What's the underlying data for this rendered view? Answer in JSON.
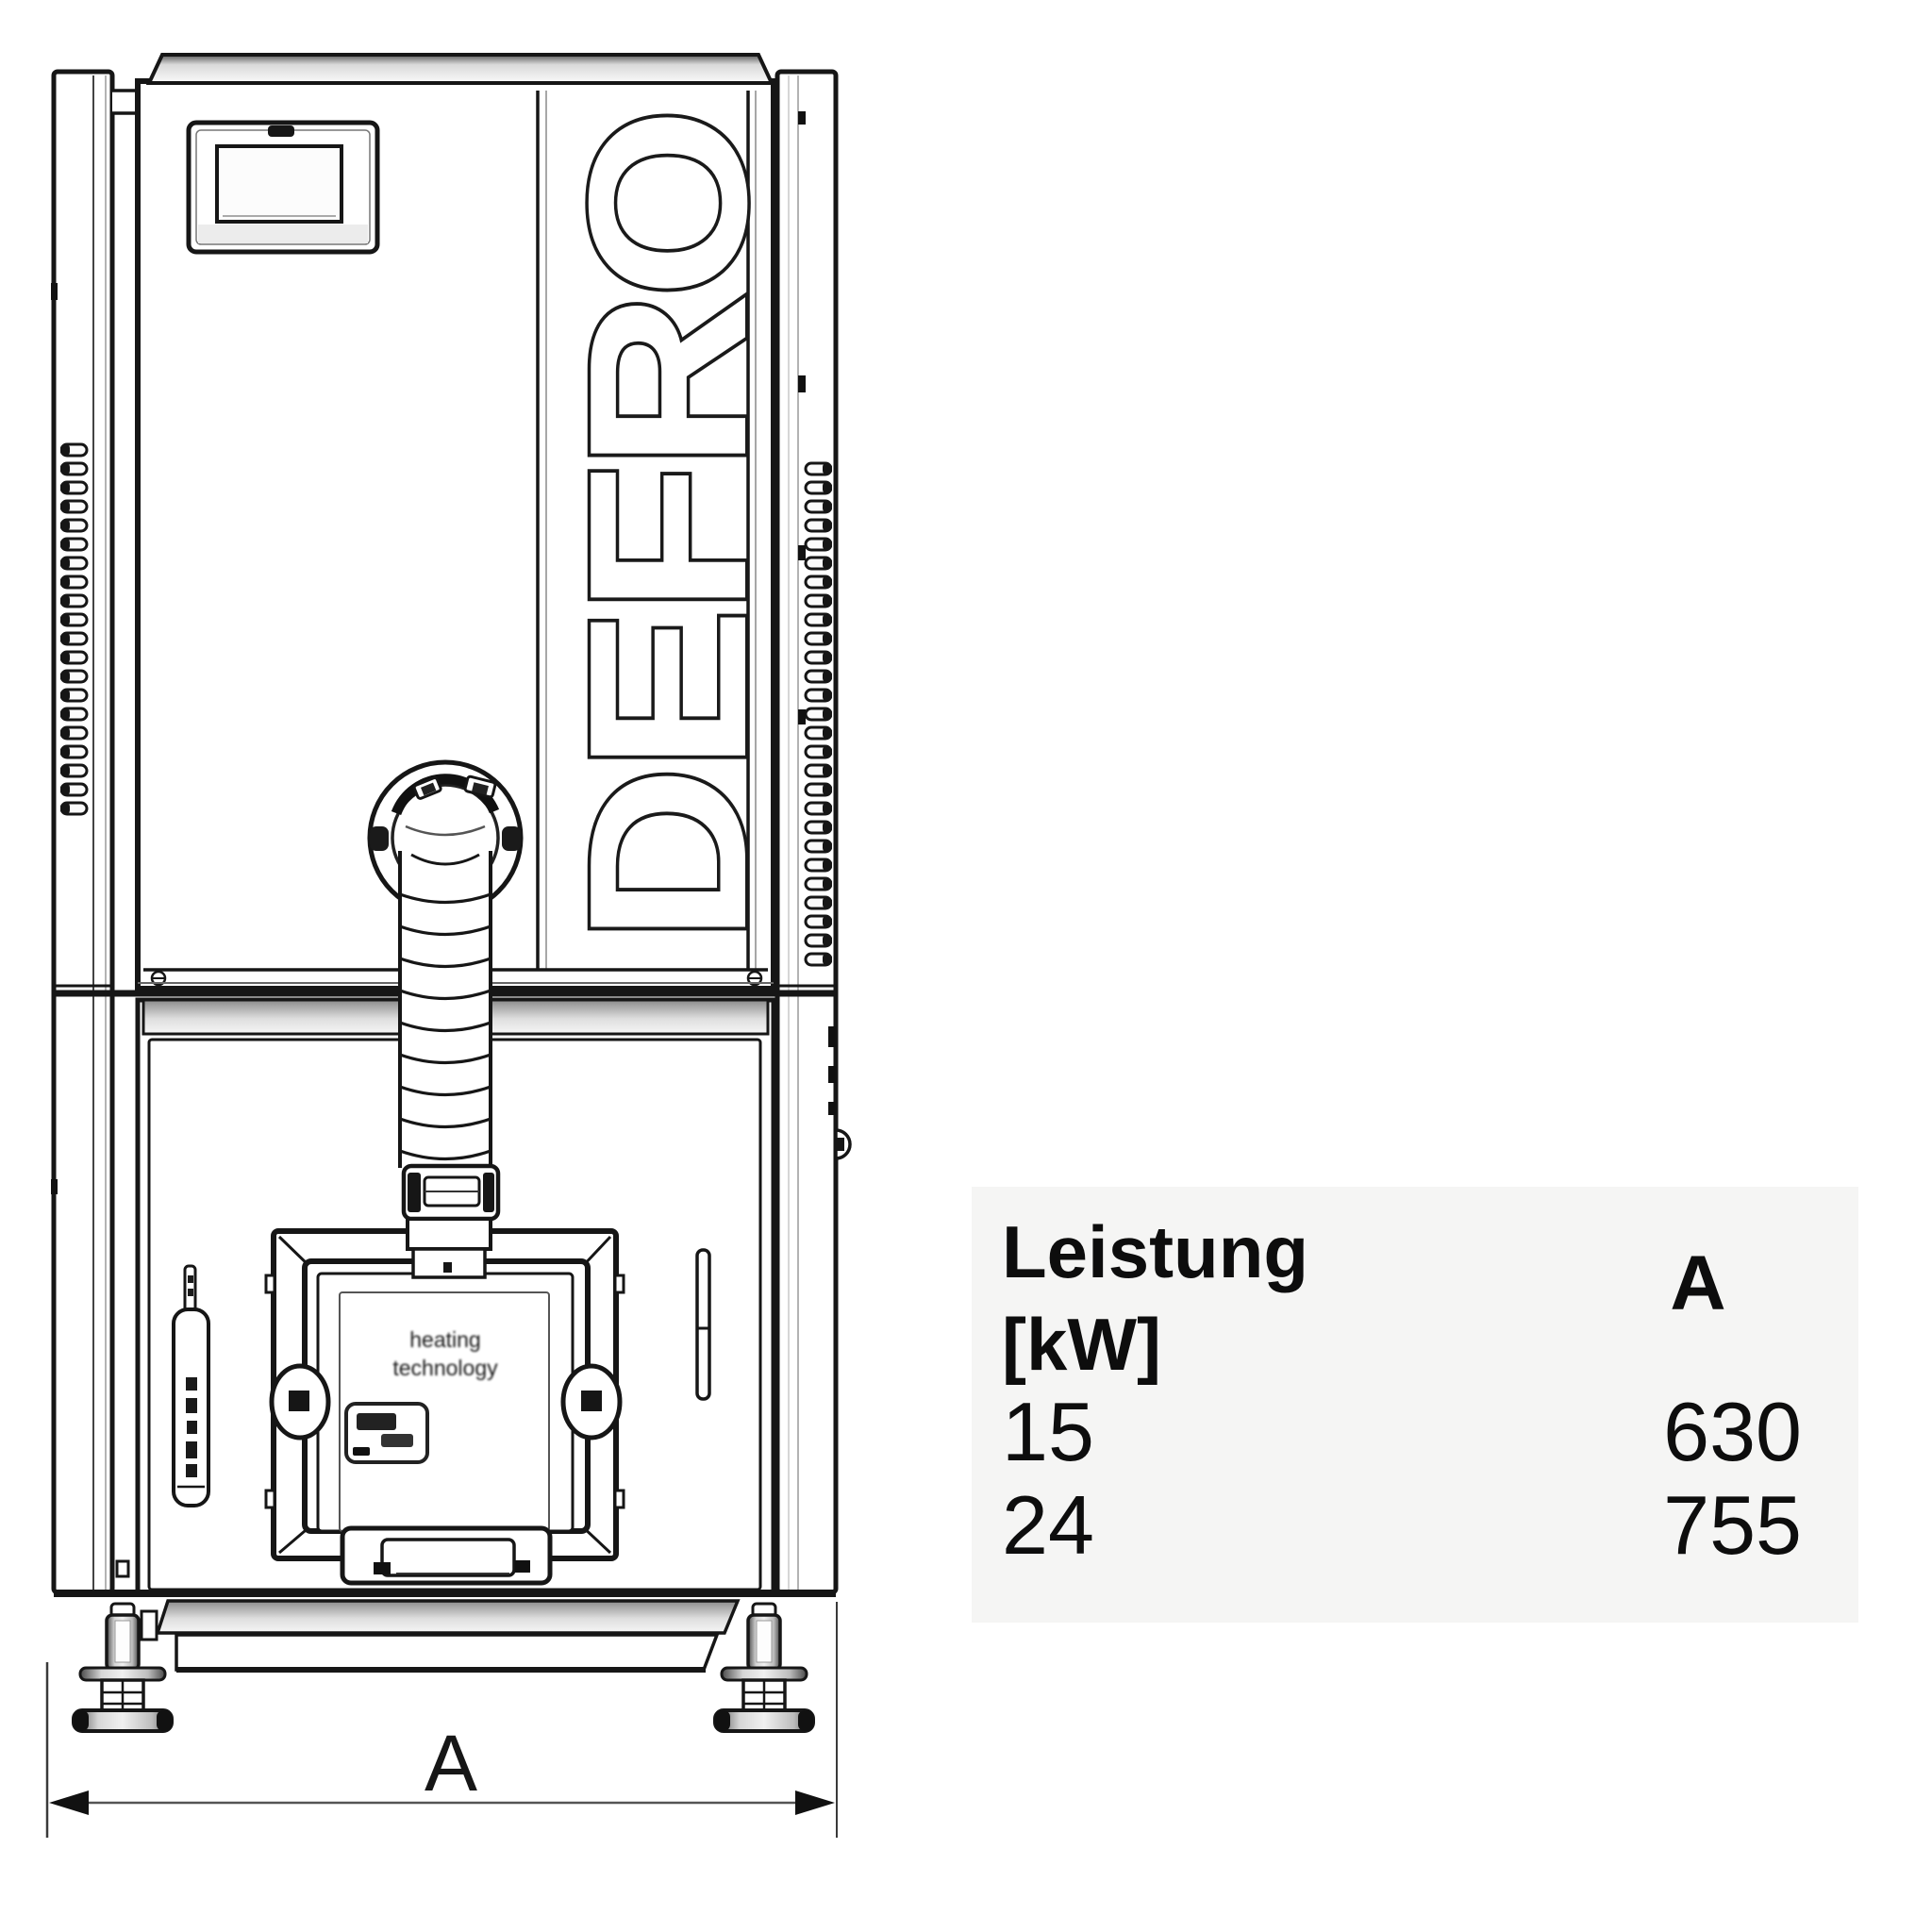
{
  "drawing": {
    "logo": "DEFRO",
    "door_label_line1": "heating",
    "door_label_line2": "technology",
    "dim_label": "A",
    "ink_color": "#161616"
  },
  "table": {
    "background_color": "#f5f5f4",
    "header": {
      "power_line1": "Leistung",
      "power_line2": "[kW]",
      "dimension": "A"
    },
    "rows": [
      {
        "power": "15",
        "dimension_a": "630"
      },
      {
        "power": "24",
        "dimension_a": "755"
      }
    ]
  }
}
